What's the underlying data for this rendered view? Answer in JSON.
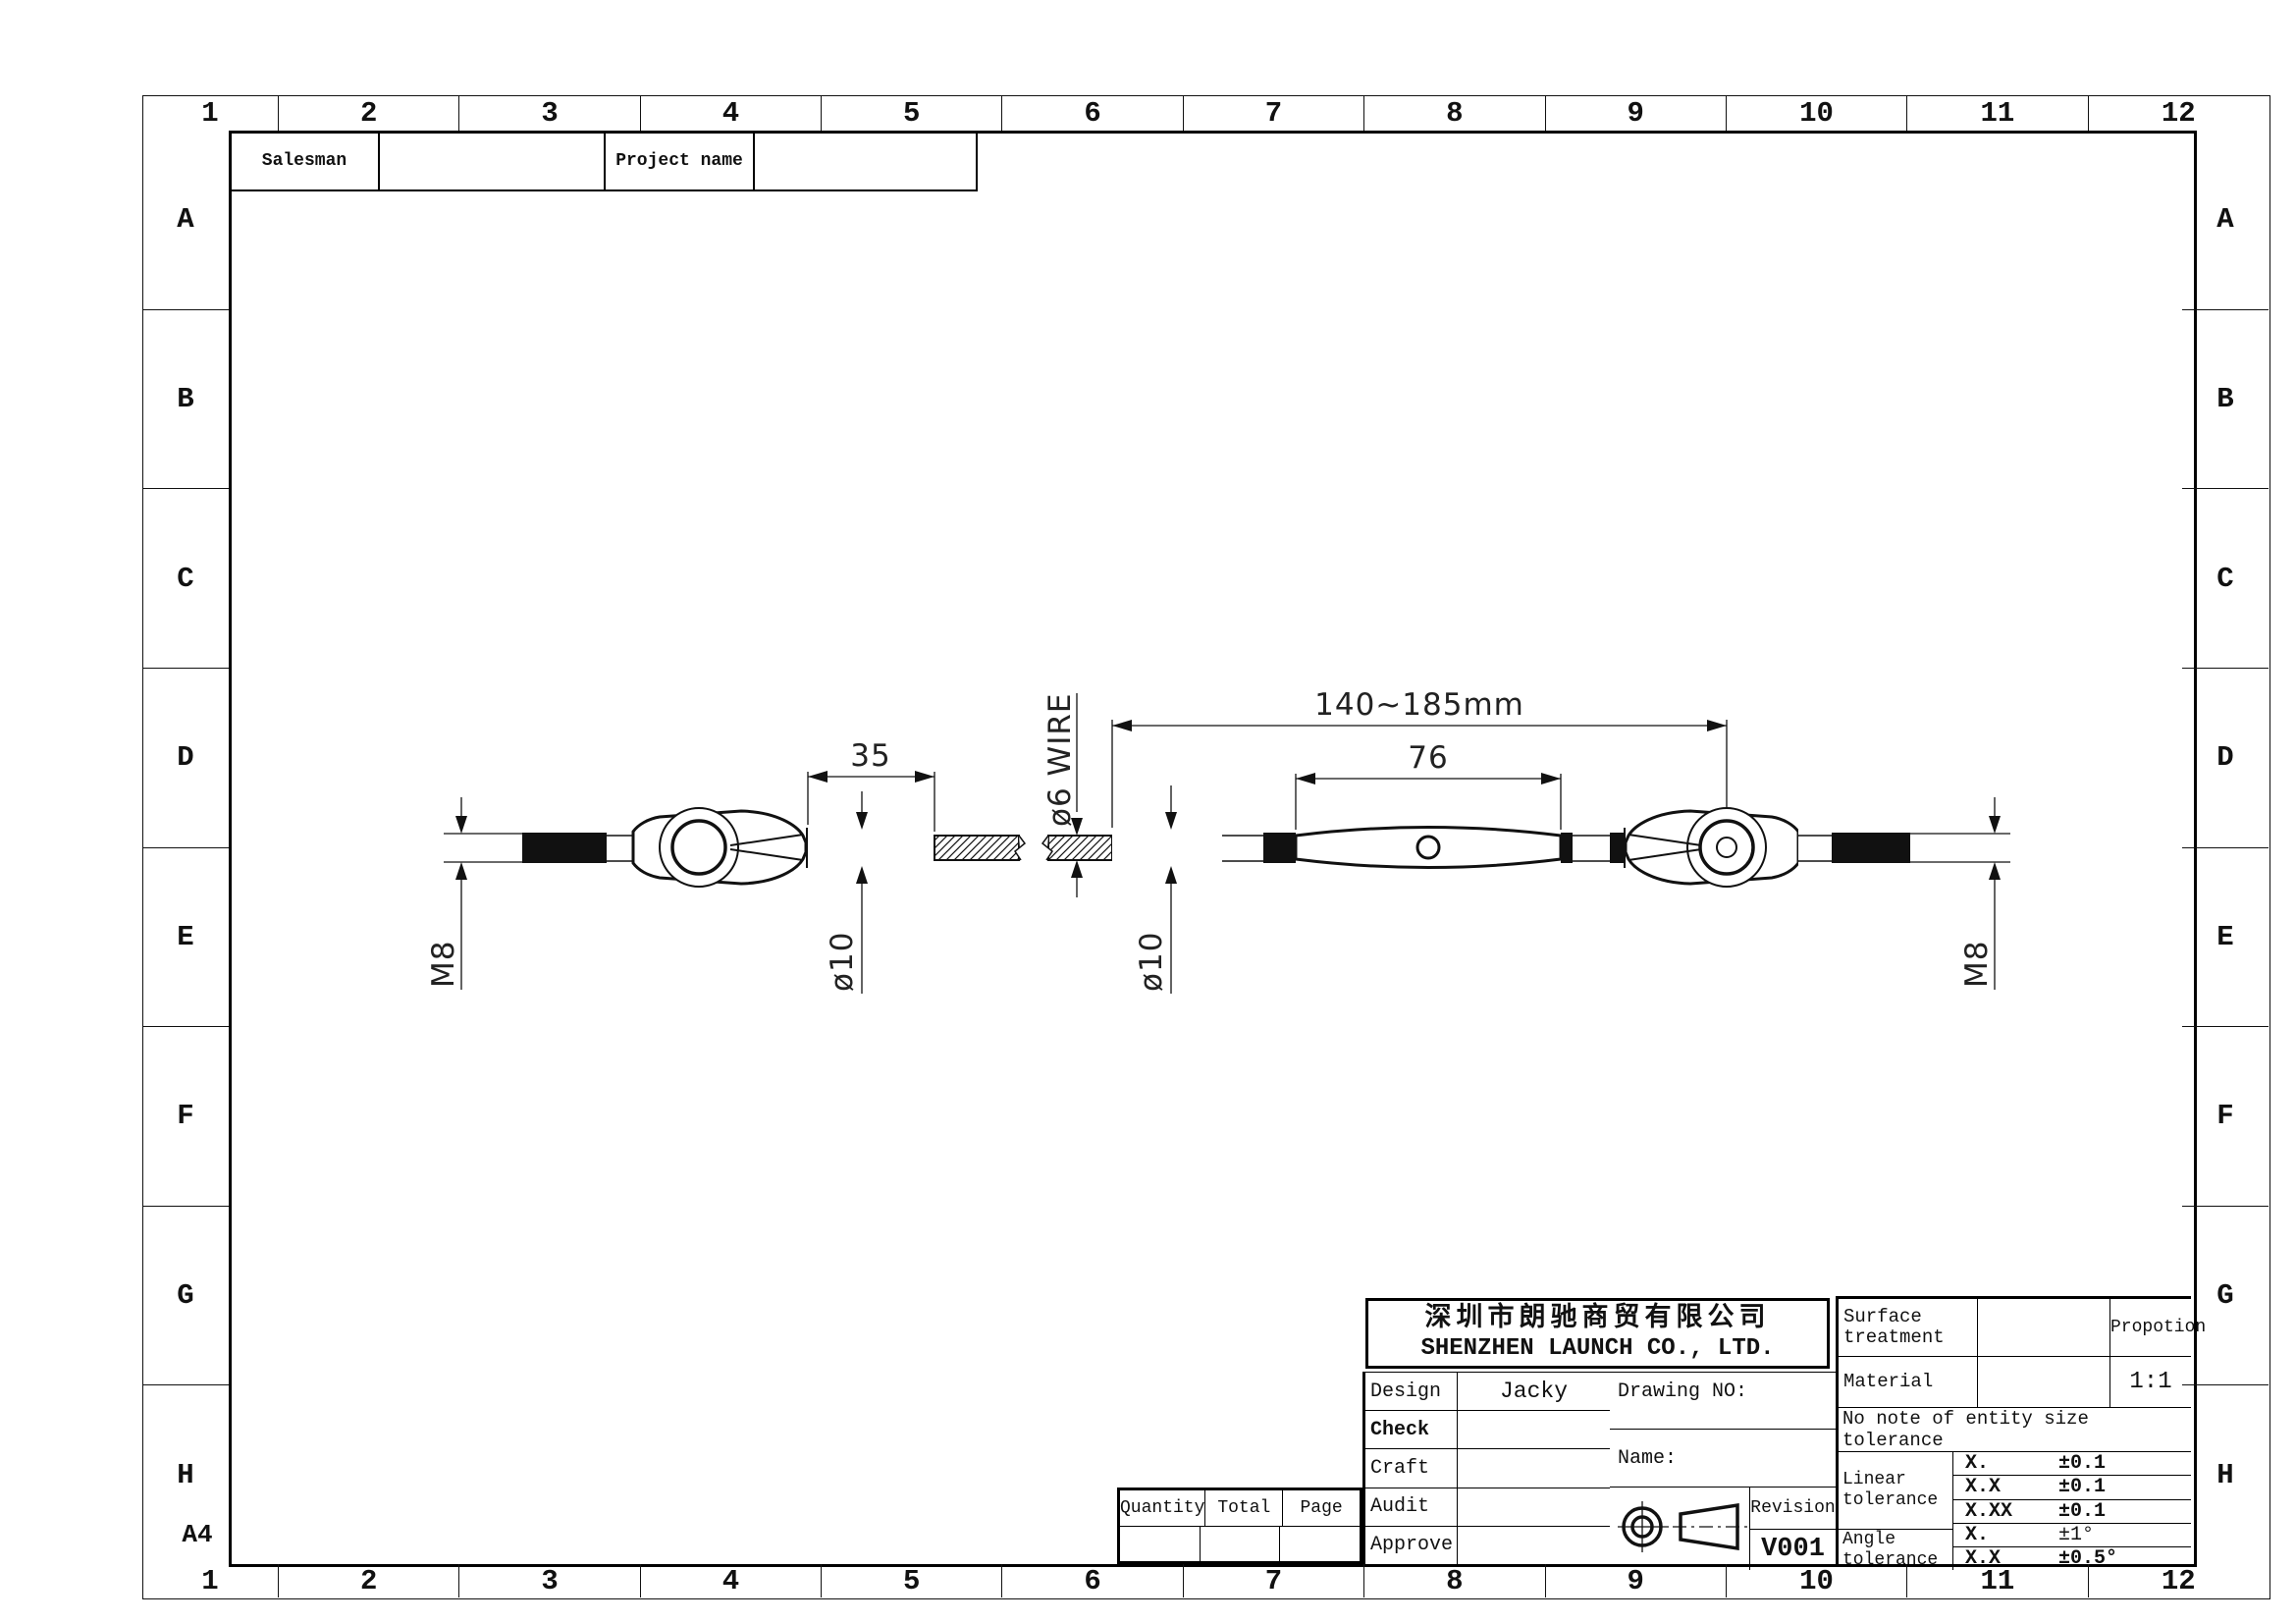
{
  "sheet": {
    "grid_cols": [
      "1",
      "2",
      "3",
      "4",
      "5",
      "6",
      "7",
      "8",
      "9",
      "10",
      "11",
      "12"
    ],
    "grid_rows": [
      "A",
      "B",
      "C",
      "D",
      "E",
      "F",
      "G",
      "H"
    ],
    "paper_size": "A4"
  },
  "header_table": {
    "salesman_label": "Salesman",
    "salesman_value": "",
    "project_label": "Project name",
    "project_value": ""
  },
  "drawing": {
    "dims": {
      "stud_thread_left": "M8",
      "swage_length_left": "35",
      "swage_dia_left": "ø10",
      "wire_dia": "ø6  WIRE",
      "swage_dia_right": "ø10",
      "body_length": "76",
      "overall_length": "140~185mm",
      "stud_thread_right": "M8"
    }
  },
  "title_block": {
    "company_cn": "深圳市朗驰商贸有限公司",
    "company_en": "SHENZHEN LAUNCH CO., LTD.",
    "sign_rows": [
      {
        "label": "Design",
        "value": "Jacky"
      },
      {
        "label": "Check",
        "value": ""
      },
      {
        "label": "Craft",
        "value": ""
      },
      {
        "label": "Audit",
        "value": ""
      },
      {
        "label": "Approve",
        "value": ""
      }
    ],
    "drawing_no_label": "Drawing NO:",
    "name_label": "Name:",
    "revision_label": "Revision",
    "revision_value": "V001",
    "surface_label": "Surface treatment",
    "surface_value": "",
    "proportion_label": "Propotion",
    "proportion_value": "1:1",
    "material_label": "Material",
    "material_value": "",
    "tolerance_note": "No note of entity size tolerance",
    "linear_label": "Linear tolerance",
    "angle_label": "Angle tolerance",
    "tolerance_rows": [
      {
        "x": "X.",
        "v": "±0.1"
      },
      {
        "x": "X.X",
        "v": "±0.1"
      },
      {
        "x": "X.XX",
        "v": "±0.1"
      },
      {
        "x": "X.",
        "v": "±1°"
      },
      {
        "x": "X.X",
        "v": "±0.5°"
      }
    ]
  },
  "quantity_table": {
    "headers": [
      "Quantity",
      "Total",
      "Page"
    ],
    "values": [
      "",
      "",
      ""
    ]
  }
}
